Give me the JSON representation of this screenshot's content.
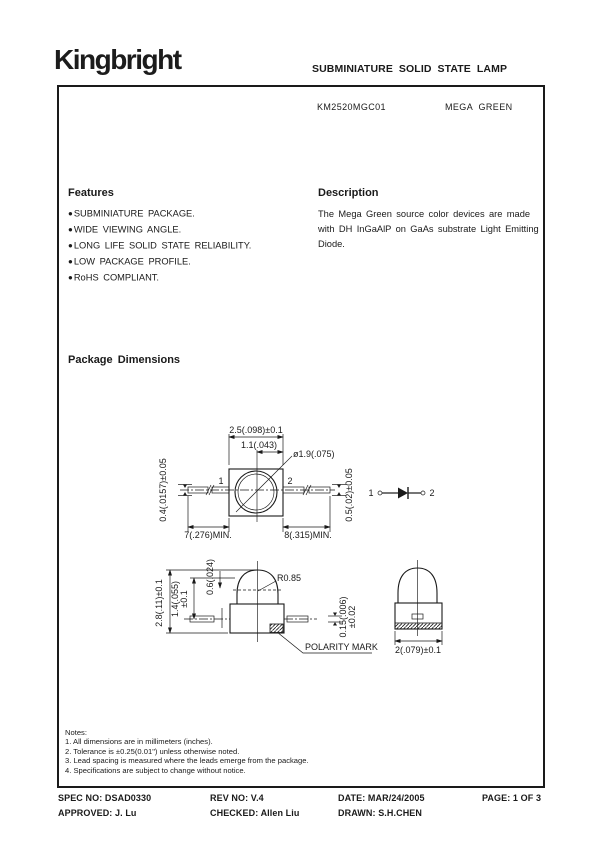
{
  "header": {
    "logo": "Kingbright",
    "doc_title": "SUBMINIATURE SOLID STATE LAMP"
  },
  "part": {
    "number": "KM2520MGC01",
    "color_name": "MEGA GREEN"
  },
  "features": {
    "title": "Features",
    "bullet": "●",
    "items": [
      "SUBMINIATURE PACKAGE.",
      "WIDE VIEWING ANGLE.",
      "LONG LIFE SOLID STATE RELIABILITY.",
      "LOW PACKAGE PROFILE.",
      "RoHS COMPLIANT."
    ]
  },
  "description": {
    "title": "Description",
    "text": "The Mega Green source color devices are made with DH InGaAlP on GaAs substrate Light Emitting Diode."
  },
  "package_dimensions": {
    "title": "Package Dimensions",
    "labels": {
      "top_width": "2.5(.098)±0.1",
      "top_half_width": "1.1(.043)",
      "lens_diameter": "ø1.9(.075)",
      "lead_width_left": "0.4(.0157)±0.05",
      "lead_width_right": "0.5(.02)±0.05",
      "lead_length_left": "7(.276)MIN.",
      "lead_length_right": "8(.315)MIN.",
      "pin1": "1",
      "pin2": "2",
      "schematic_pin1": "1",
      "schematic_pin2": "2",
      "total_height": "2.8(.11)±0.1",
      "body_height": "1.4(.055)",
      "body_height_tol": "±0.1",
      "dome_offset": "0.6(.024)",
      "dome_radius": "R0.85",
      "lead_thickness": "0.15(.006)",
      "lead_thickness_tol": "±0.02",
      "polarity_mark": "POLARITY MARK",
      "front_width": "2(.079)±0.1"
    }
  },
  "notes": {
    "title": "Notes:",
    "items": [
      "1. All dimensions are in millimeters (inches).",
      "2. Tolerance is ±0.25(0.01\") unless otherwise noted.",
      "3. Lead spacing is measured where the leads emerge from the package.",
      "4. Specifications are subject to change without notice."
    ]
  },
  "footer": {
    "spec_no": "SPEC NO: DSAD0330",
    "rev_no": "REV NO: V.4",
    "date": "DATE: MAR/24/2005",
    "page": "PAGE:  1 OF 3",
    "approved": "APPROVED: J. Lu",
    "checked": "CHECKED: Allen Liu",
    "drawn": "DRAWN: S.H.CHEN"
  },
  "colors": {
    "ink": "#1a1a1a",
    "paper": "#ffffff"
  }
}
